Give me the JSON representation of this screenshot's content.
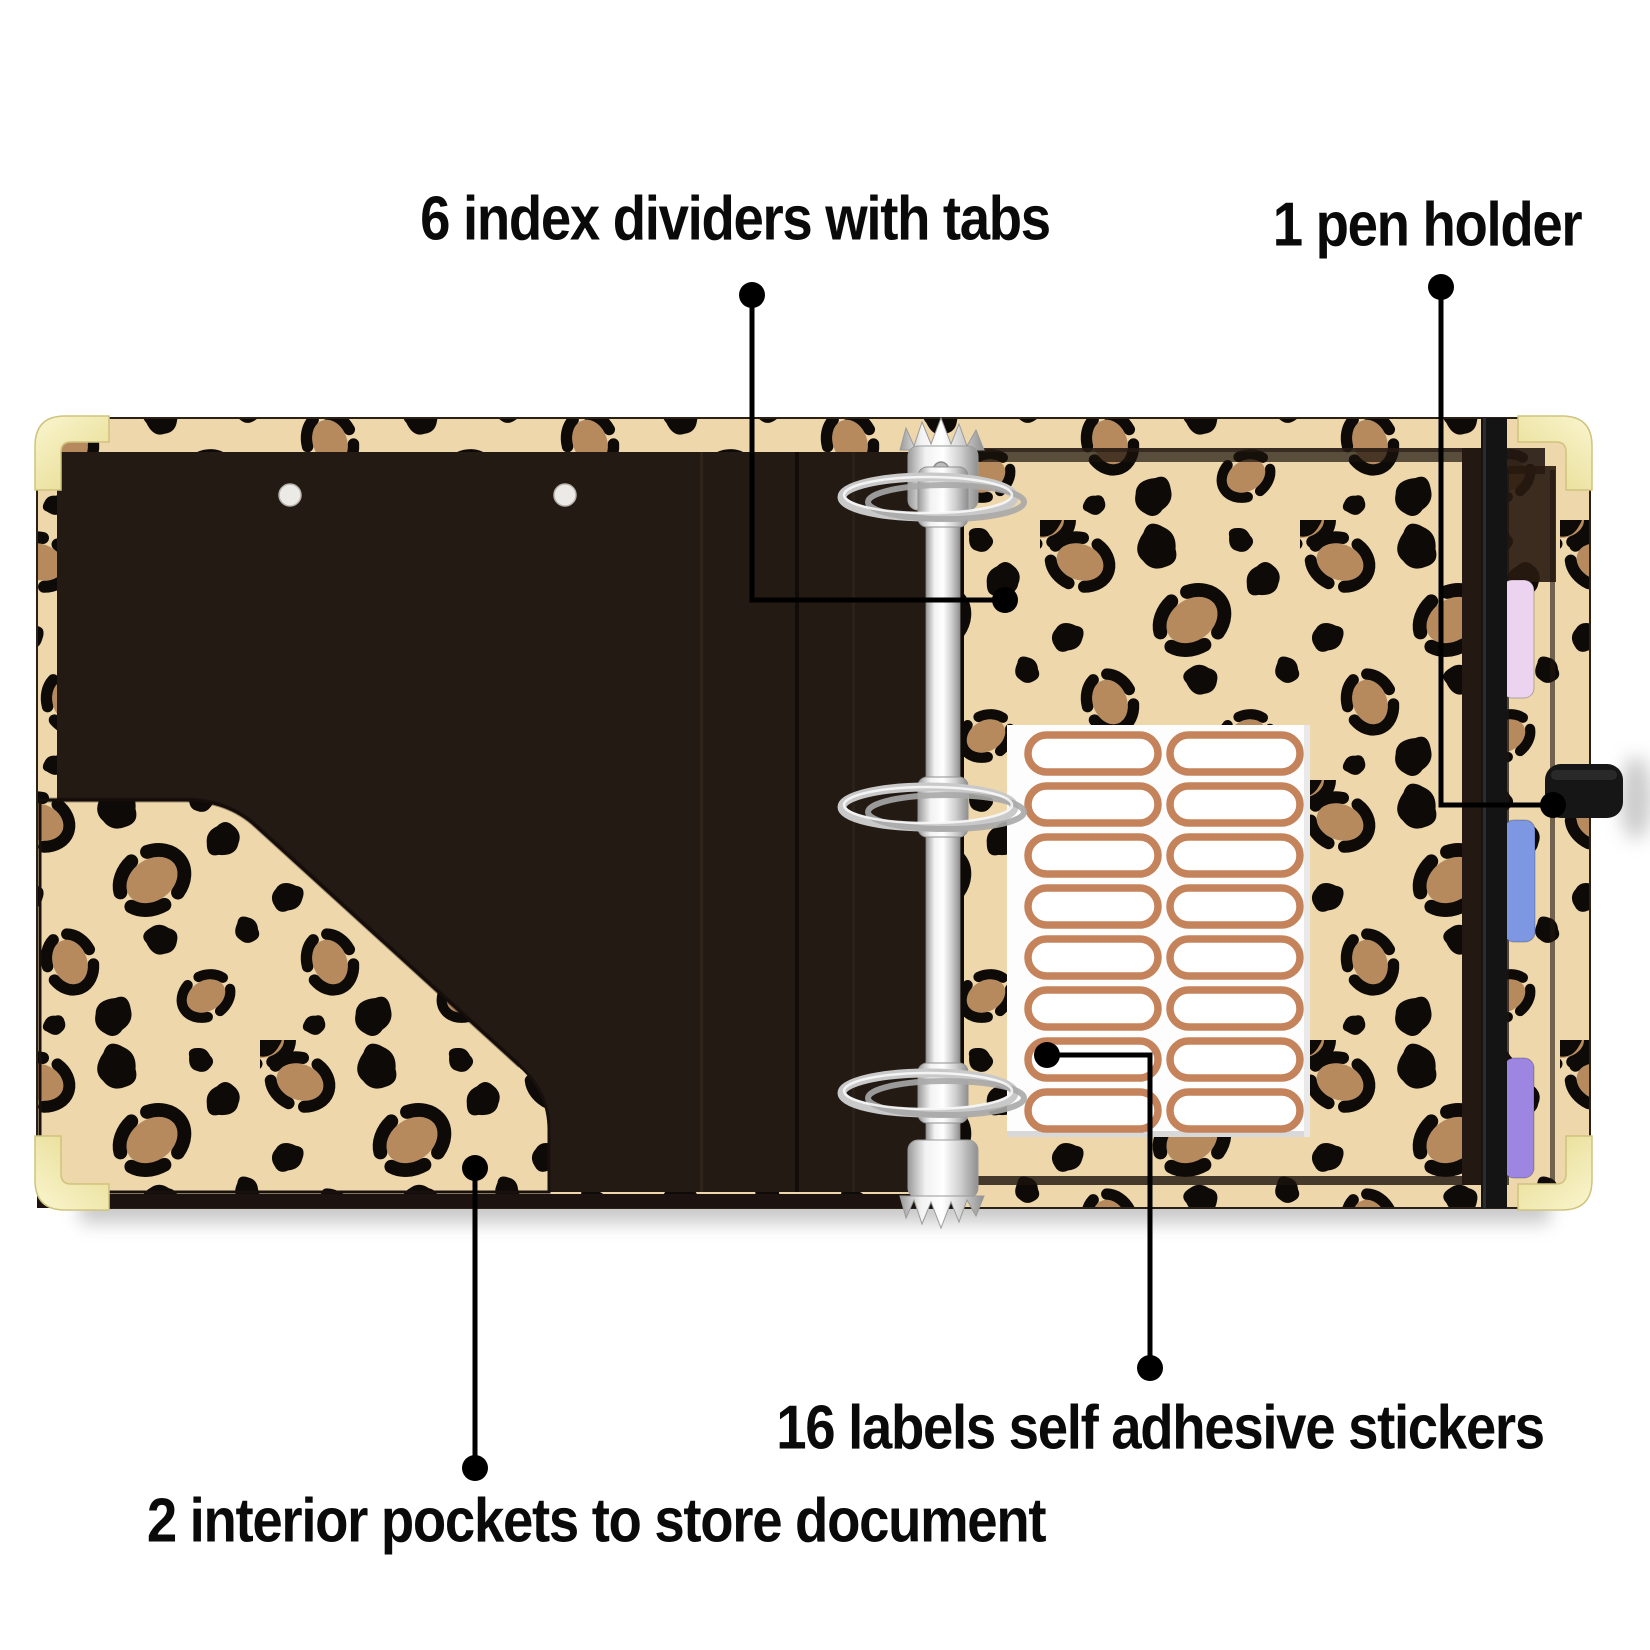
{
  "page": {
    "background": "#ffffff"
  },
  "annotations": {
    "index_dividers": {
      "label": "6 index dividers with tabs"
    },
    "pen_holder": {
      "label": "1 pen holder"
    },
    "adhesive_labels": {
      "label": "16 labels self adhesive stickers"
    },
    "interior_pockets": {
      "label": "2 interior pockets to store document"
    }
  },
  "binder": {
    "description": "open leopard-print 3-ring binder, interior view",
    "ring_count": 3,
    "visible_tab_count": 3,
    "rivet_count": 2,
    "colors": {
      "leopard_base": "#eed7ab",
      "leopard_spot_black": "#0e0a07",
      "leopard_spot_brown": "#b78a5e",
      "leopard_spot_dark_brown": "#8a5f3d",
      "interior_panel": "#241a14",
      "bottom_edge": "#1c1310",
      "gold_corner": "#f5efb6",
      "elastic_band": "#141414",
      "pen_loop": "#161616",
      "tab_pink": "#ecd4f0",
      "tab_blue": "#7e97e3",
      "tab_purple": "#9d86e2",
      "rivet": "#eceae7",
      "callout_line": "#000000",
      "annotation_text": "#0a0a0a"
    }
  },
  "sticker_sheet": {
    "label_count": 16,
    "rows": 8,
    "columns": 2,
    "sheet_color": "#fdfdfd",
    "sticker_outline": "#c5835c"
  }
}
